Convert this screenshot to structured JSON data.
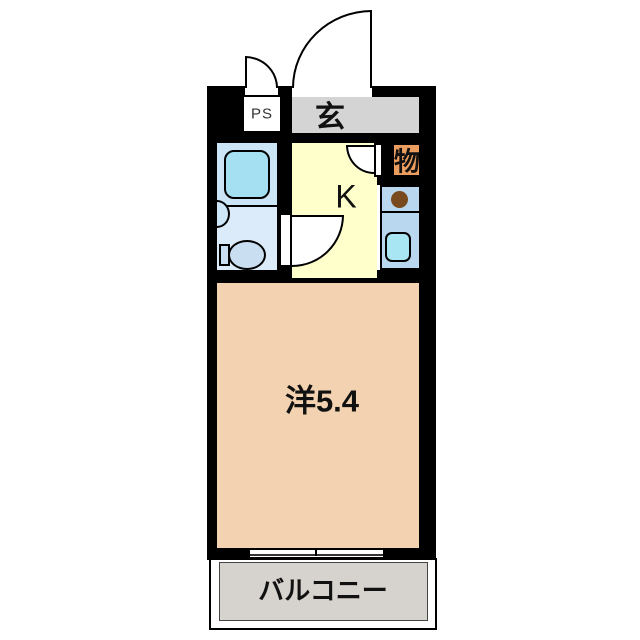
{
  "plan": {
    "type": "apartment-floor-plan",
    "labels": {
      "ps": "PS",
      "entrance": "玄",
      "closet": "物",
      "kitchen": "K",
      "main_room": "洋5.4",
      "balcony": "バルコニー"
    },
    "colors": {
      "wall": "#000000",
      "entrance": "#d4d4d4",
      "closet": "#ec9e5e",
      "kitchen": "#ffffcc",
      "main_room": "#f2d2b0",
      "balcony": "#d6d2cd",
      "bathroom": "#dcebf9",
      "bathroom_upper": "#cbe5f6",
      "bathtub": "#a5e0f2",
      "basin": "#cde7f8",
      "toilet": "#c9def1",
      "counter": "#b9d8ef",
      "sink": "#a9e6f4",
      "burner": "#7a4a1f"
    },
    "fixtures": [
      "bathtub",
      "wash-basin",
      "toilet",
      "stove-burner",
      "kitchen-sink",
      "entrance-door-swing",
      "ps-door-swing",
      "closet-door-swing",
      "kitchen-door-swing",
      "sliding-window"
    ]
  }
}
